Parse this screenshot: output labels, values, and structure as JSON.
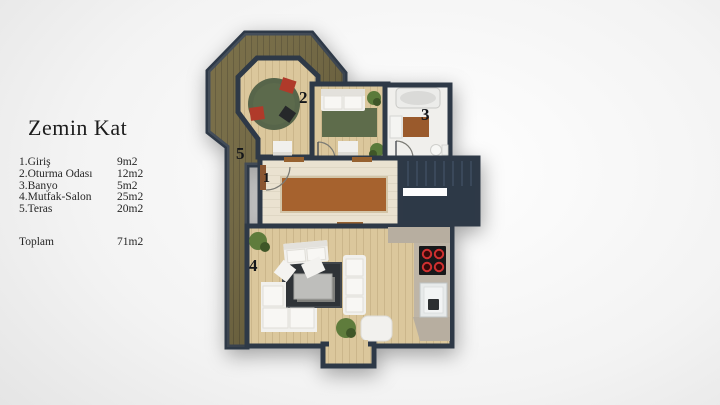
{
  "legend": {
    "title": "Zemin Kat",
    "items": [
      {
        "label": "1.Giriş",
        "value": "9m2"
      },
      {
        "label": "2.Oturma Odası",
        "value": "12m2"
      },
      {
        "label": "3.Banyo",
        "value": "5m2"
      },
      {
        "label": "4.Mutfak-Salon",
        "value": "25m2"
      },
      {
        "label": "5.Teras",
        "value": "20m2"
      }
    ],
    "total": {
      "label": "Toplam",
      "value": "71m2"
    }
  },
  "floorplan": {
    "room_numbers": {
      "entry": "1",
      "living_room": "2",
      "bathroom": "3",
      "kitchen_salon": "4",
      "terrace": "5"
    },
    "colors": {
      "wall": "#2e3947",
      "wood_floor": "#dbc79c",
      "pale_floor": "#eae2d0",
      "terrace_wood": "#6b5f34",
      "stairs": "#2d3947",
      "green_rug": "#5c6b49",
      "brown_rug": "#a6622e",
      "dark_rug": "#2f3337",
      "red_chair": "#b03a2a",
      "stove_burner": "#d03030"
    }
  }
}
